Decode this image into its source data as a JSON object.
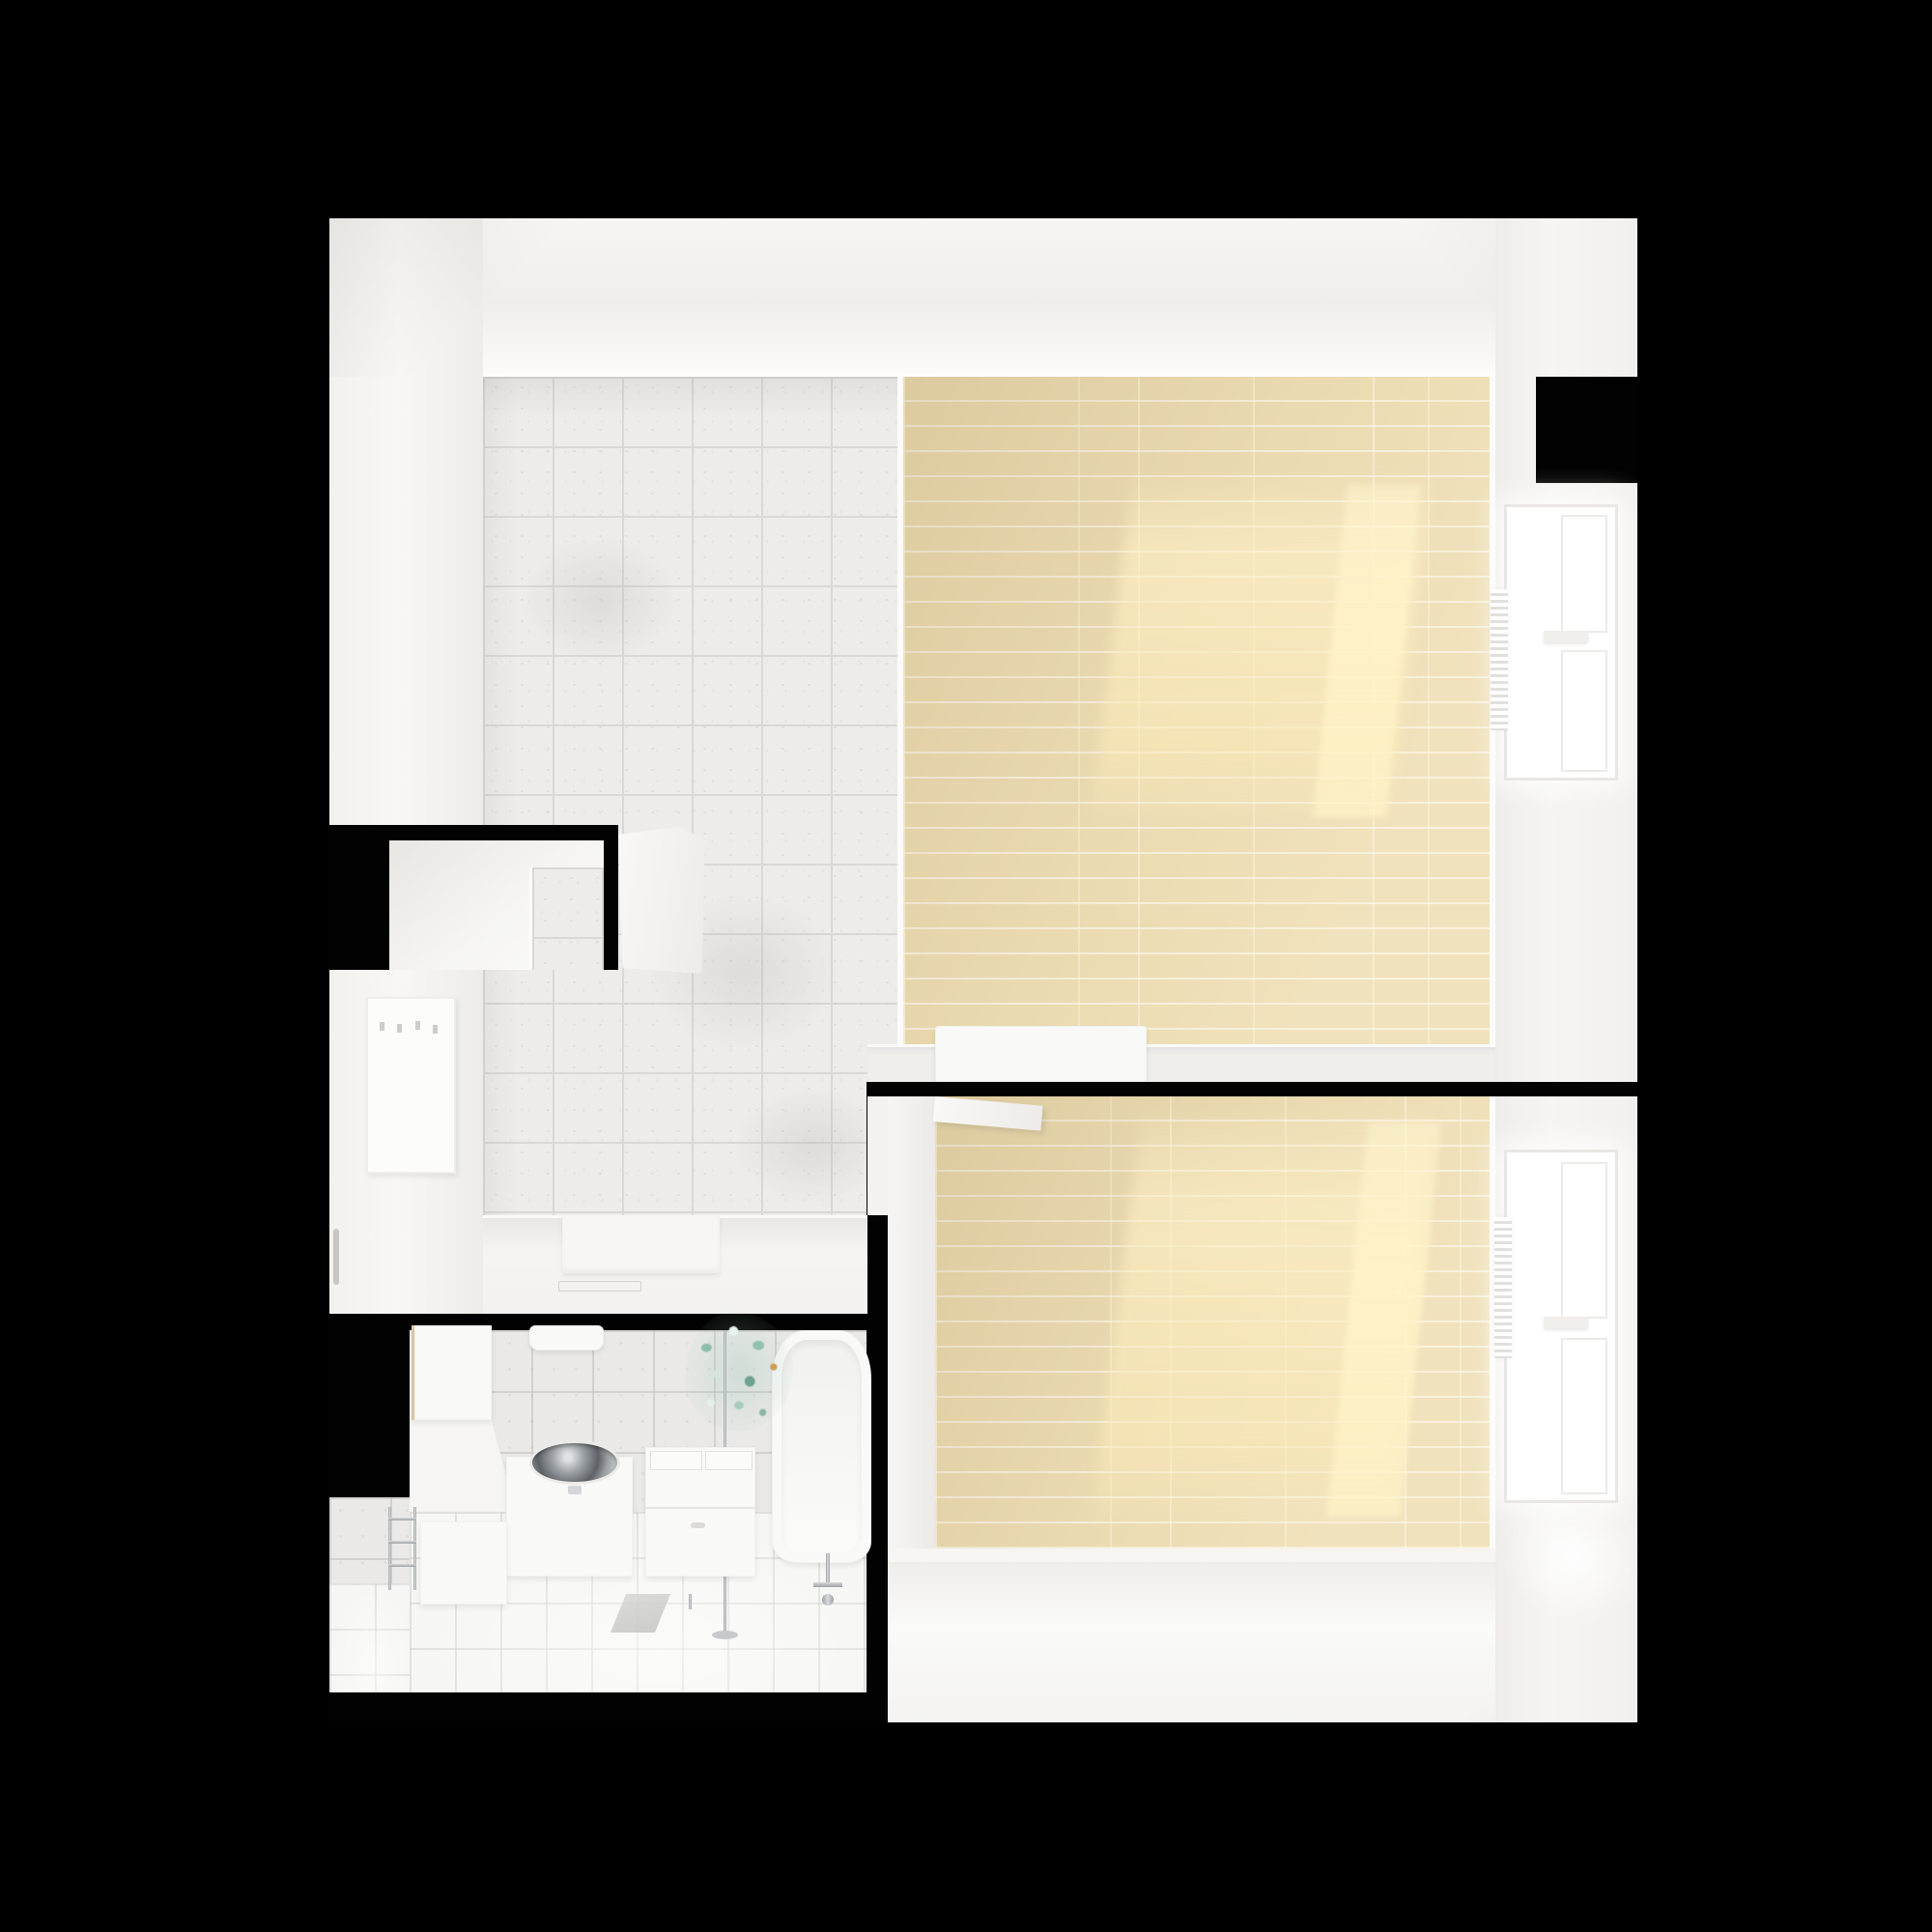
{
  "scene": {
    "kind": "top-down-apartment-render",
    "rooms": [
      "entry-hall",
      "kitchen",
      "living-room",
      "bedroom",
      "bathroom"
    ],
    "window_count": 2
  },
  "palette": {
    "bg": "#000000",
    "wall": "#f4f3f1",
    "wall_bright": "#fbfbfa",
    "wall_dim": "#e9e7e4",
    "tile": "#edecea",
    "tile_line": "#d9d8d5",
    "wood": "#ecdcb2",
    "wood_line": "#f6efdb",
    "sun": "#fdf0c8",
    "bath_wall": "#eae9e7",
    "bath_floor": "#f6f6f4",
    "steel": "#a9adb0",
    "chrome": "#c0c3c5",
    "fixture": "#f9f9f8",
    "plant": "#8cbcab",
    "plant_accent": "#cf9c55"
  }
}
